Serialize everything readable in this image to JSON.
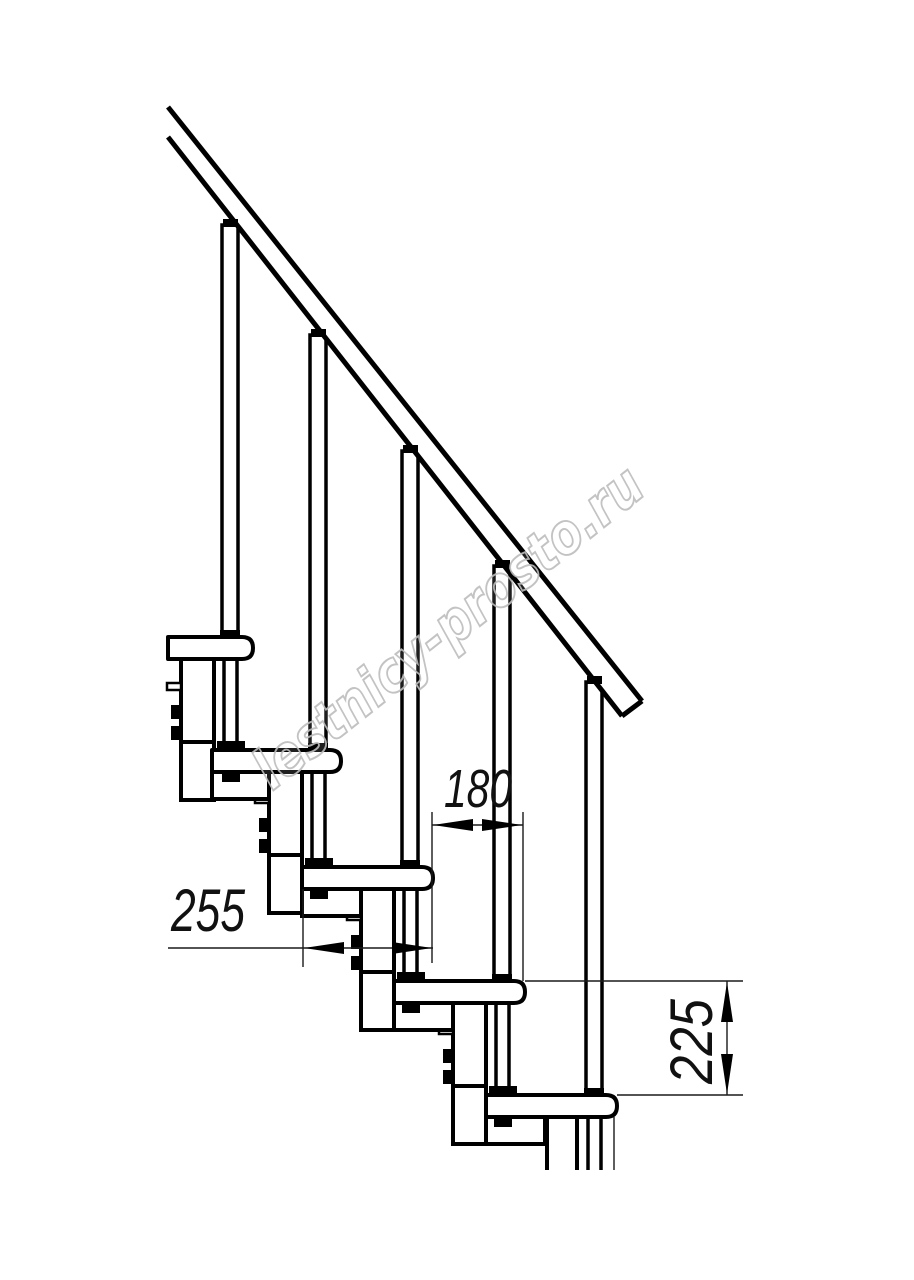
{
  "watermark": {
    "text": "lestnicy-prosto.ru",
    "color": "#bdbdbd"
  },
  "dimensions": {
    "tread_depth": "255",
    "step_run": "180",
    "step_height": "225"
  },
  "drawing": {
    "tread_count": 5,
    "view": "staircase-side-view"
  },
  "colors": {
    "line": "#000000",
    "thin_line": "#1a1a1a",
    "watermark": "#bdbdbd",
    "background": "#ffffff"
  }
}
